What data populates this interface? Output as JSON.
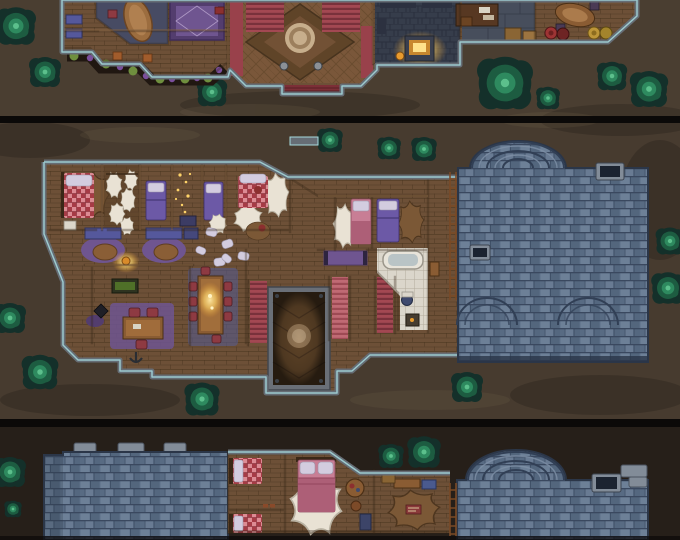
{
  "artwork": {
    "kind": "top-down fantasy tabletop battle map",
    "subject": "Three stacked cut-away floor sections of a stone manor with blue slate roofs, wooden interiors and a dark dirt yard dotted with round trees",
    "strips": [
      {
        "name": "upper-floor",
        "features": [
          "great hall with parquet floor and round medallion",
          "twin red carpeted staircases",
          "red wall runners",
          "front porch steps",
          "flower planter border with green bushes and purple blooms",
          "oval banquet table room",
          "ornate purple carpet room",
          "blue benches",
          "forge room with glowing furnace",
          "study desk with books",
          "round side table",
          "red and yellow barrels",
          "wooden crates"
        ]
      },
      {
        "name": "main-floor",
        "features": [
          "bedroom with red checkered bed",
          "fur-pelt closet",
          "two purple-bed cells",
          "gold-dust room",
          "red checkered bed room with fur rugs",
          "lounge with purple round rugs, cushioned benches and leather poufs",
          "hanging oil lamp",
          "study with desk, red chairs and purple rug",
          "alchemy side table",
          "dining room with long candle-lit table and red chairs",
          "open stairwell showing parquet floor below",
          "red and pink staircases",
          "purple hallway runner",
          "bathroom with tub, toilet and stove",
          "pink and purple bedrooms with fur rugs",
          "large blue slate roof with arched ridges, two skylights and a wooden ladder",
          "scattered white pillows"
        ]
      },
      {
        "name": "lower-floor",
        "features": [
          "left slate roof with three chimney caps",
          "two red checkered bed cells",
          "pink bed room with huge white fur rug",
          "round tea table and stool",
          "den with brown fur rug, bench and blue chest",
          "small patterned mat",
          "right slate roof with arched ridge, skylight and ladder"
        ]
      }
    ],
    "tree_count": 20
  },
  "palette": {
    "ground": "#473b2f",
    "groundTop": "#4a3e31",
    "groundBottom": "#261f19",
    "divider": "#0b0908",
    "treeOuter": "#14302a",
    "treeMid": "#1d5c41",
    "treeIn": "#2e8a5f",
    "treeCore": "#5cc08c",
    "wallStone": "#666d75",
    "wallTeal": "#a6dade",
    "wood": "#6d5037",
    "woodDark": "#594027",
    "woodLine": "#47331e",
    "beam": "#8a6744",
    "beamDark": "#33241455",
    "parquet": "#7a573a",
    "parquetDark": "#5f4428",
    "medallion": "#c7ae8c",
    "medallionDark": "#9c7f5d",
    "hallRed": "#99414b",
    "stairRed": "#a34852",
    "stairDark": "#79313b",
    "stairPink": "#c06a74",
    "carpetPurple": "#6f5590",
    "carpetPurpleDark": "#533d6e",
    "bedPurple": "#6c59a6",
    "pillow": "#d3ccdf",
    "bedRed": "#a63b45",
    "bedRedLight": "#dc8b93",
    "bedPink": "#c87e95",
    "bedPinkDark": "#ad5f77",
    "furWhite": "#e9e2d4",
    "furBrown": "#7b5836",
    "roof": "#5d7089",
    "roofLight": "#7e90a6",
    "roofDark": "#475a70",
    "roofLine": "#313f55",
    "chimney": "#828c98",
    "tileWhite": "#dbd6cb",
    "tileLine": "#b3ac9e",
    "glow": "#ffd469",
    "glowDeep": "#e89b2e",
    "deskWood": "#8a5c33",
    "chairRed": "#8e3a42",
    "benchBlue": "#55589c",
    "plantGreen": "#6f8f3e",
    "plantPurple": "#7b4f9c",
    "soil": "#201711",
    "stoneFloor": "#474e5c",
    "stoneFloorDark": "#363d4b",
    "barrelRed": "#9e3434",
    "barrelYellow": "#bd9639",
    "crate": "#8a6534",
    "porchRed": "#7c2f37",
    "water": "#b9c4c6",
    "ladder": "#7a4a26"
  }
}
